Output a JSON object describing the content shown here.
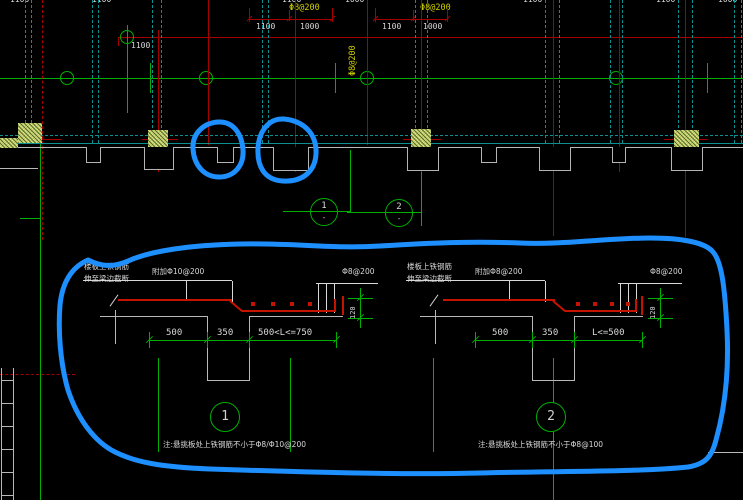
{
  "colors": {
    "background": "#000000",
    "grid_green": "#00b000",
    "line_red": "#a50000",
    "rebar_red": "#c41400",
    "axis_teal": "#0e8f8f",
    "outline_gray": "#b9b9b9",
    "text_white": "#d8d8d8",
    "callout_yellow": "#cfcf00",
    "hatch_fill": "#b6c65f",
    "marker_blue": "#1e8fff"
  },
  "top": {
    "cut_labels": [
      "1100",
      "1100",
      "1100",
      "1000",
      "1100",
      "1100",
      "1000"
    ],
    "callout_left": "Φ8@200",
    "callout_right": "Φ8@200",
    "callout_vertical": "Φ8@200",
    "dim_group_a": {
      "d1": "1100",
      "d2": "1000"
    },
    "dim_group_b": {
      "d1": "1100",
      "d2": "1000"
    },
    "offset_label": "1100",
    "section_bubble_1": {
      "number": "1",
      "dash": "-"
    },
    "section_bubble_2": {
      "number": "2",
      "dash": "-"
    }
  },
  "panel": {
    "left_detail": {
      "rebar_note_line1": "楼板上铁钢筋",
      "rebar_note_line2": "伸至梁边截断",
      "added_bar_label": "附加Φ10@200",
      "edge_bar_label": "Φ8@200",
      "dim_left": "500",
      "dim_mid": "350",
      "dim_right": "500<L<=750",
      "dim_thickness": "120",
      "bubble_number": "1",
      "note": "注:悬挑板处上铁钢筋不小于Φ8/Φ10@200"
    },
    "right_detail": {
      "rebar_note_line1": "楼板上铁钢筋",
      "rebar_note_line2": "伸至梁边截断",
      "added_bar_label": "附加Φ8@200",
      "edge_bar_label": "Φ8@200",
      "dim_left": "500",
      "dim_mid": "350",
      "dim_right": "L<=500",
      "dim_thickness": "120",
      "bubble_number": "2",
      "note": "注:悬挑板处上铁钢筋不小于Φ8@100"
    }
  }
}
